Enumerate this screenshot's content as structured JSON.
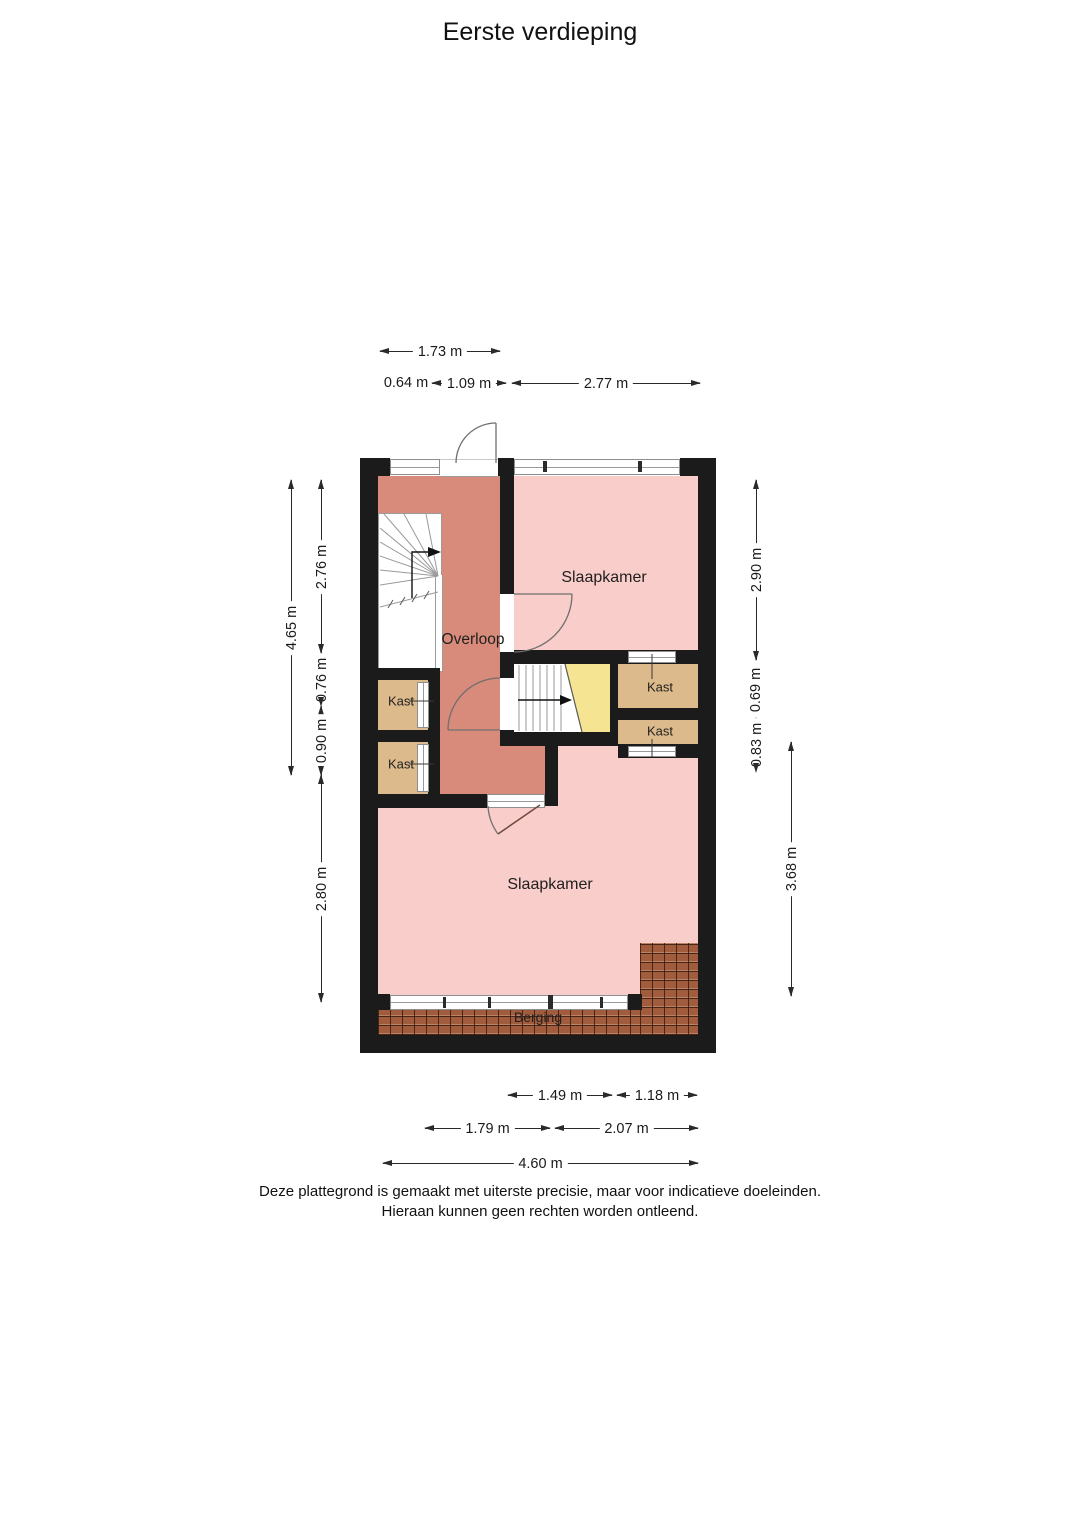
{
  "title": "Eerste verdieping",
  "floor_plan": {
    "rooms": [
      {
        "id": "slaapkamer-top",
        "label": "Slaapkamer"
      },
      {
        "id": "slaapkamer-bottom",
        "label": "Slaapkamer"
      },
      {
        "id": "overloop",
        "label": "Overloop"
      },
      {
        "id": "kast-left-1",
        "label": "Kast"
      },
      {
        "id": "kast-left-2",
        "label": "Kast"
      },
      {
        "id": "kast-right-1",
        "label": "Kast"
      },
      {
        "id": "kast-right-2",
        "label": "Kast"
      },
      {
        "id": "berging",
        "label": "Berging"
      }
    ],
    "features": [
      "stairs-down-winder",
      "stairs-up-to-attic",
      "door-swings",
      "windows",
      "roof-tiles"
    ],
    "colors": {
      "wall": "#1b1b1b",
      "landing_floor": "#d88b7a",
      "bedroom_floor": "#f9cdc9",
      "closet_floor": "#dcba8b",
      "attic_stair_floor": "#f5e593",
      "roof_tiles": "#a05c3c",
      "frame_lines": "#8e8e8e"
    }
  },
  "dimensions": {
    "top": [
      {
        "label": "1.73 m"
      },
      {
        "label": "0.64 m"
      },
      {
        "label": "1.09 m"
      },
      {
        "label": "2.77 m"
      }
    ],
    "left": [
      {
        "label": "4.65 m"
      },
      {
        "label": "2.76 m"
      },
      {
        "label": "0.76 m"
      },
      {
        "label": "0.90 m"
      },
      {
        "label": "2.80 m"
      }
    ],
    "right": [
      {
        "label": "2.90 m"
      },
      {
        "label": "0.69 m"
      },
      {
        "label": "0.83 m"
      },
      {
        "label": "3.68 m"
      }
    ],
    "bottom": [
      {
        "label": "1.49 m"
      },
      {
        "label": "1.18 m"
      },
      {
        "label": "1.79 m"
      },
      {
        "label": "2.07 m"
      },
      {
        "label": "4.60 m"
      }
    ]
  },
  "disclaimer": {
    "line1": "Deze plattegrond is gemaakt met uiterste precisie, maar voor indicatieve doeleinden.",
    "line2": "Hieraan kunnen geen rechten worden ontleend."
  }
}
